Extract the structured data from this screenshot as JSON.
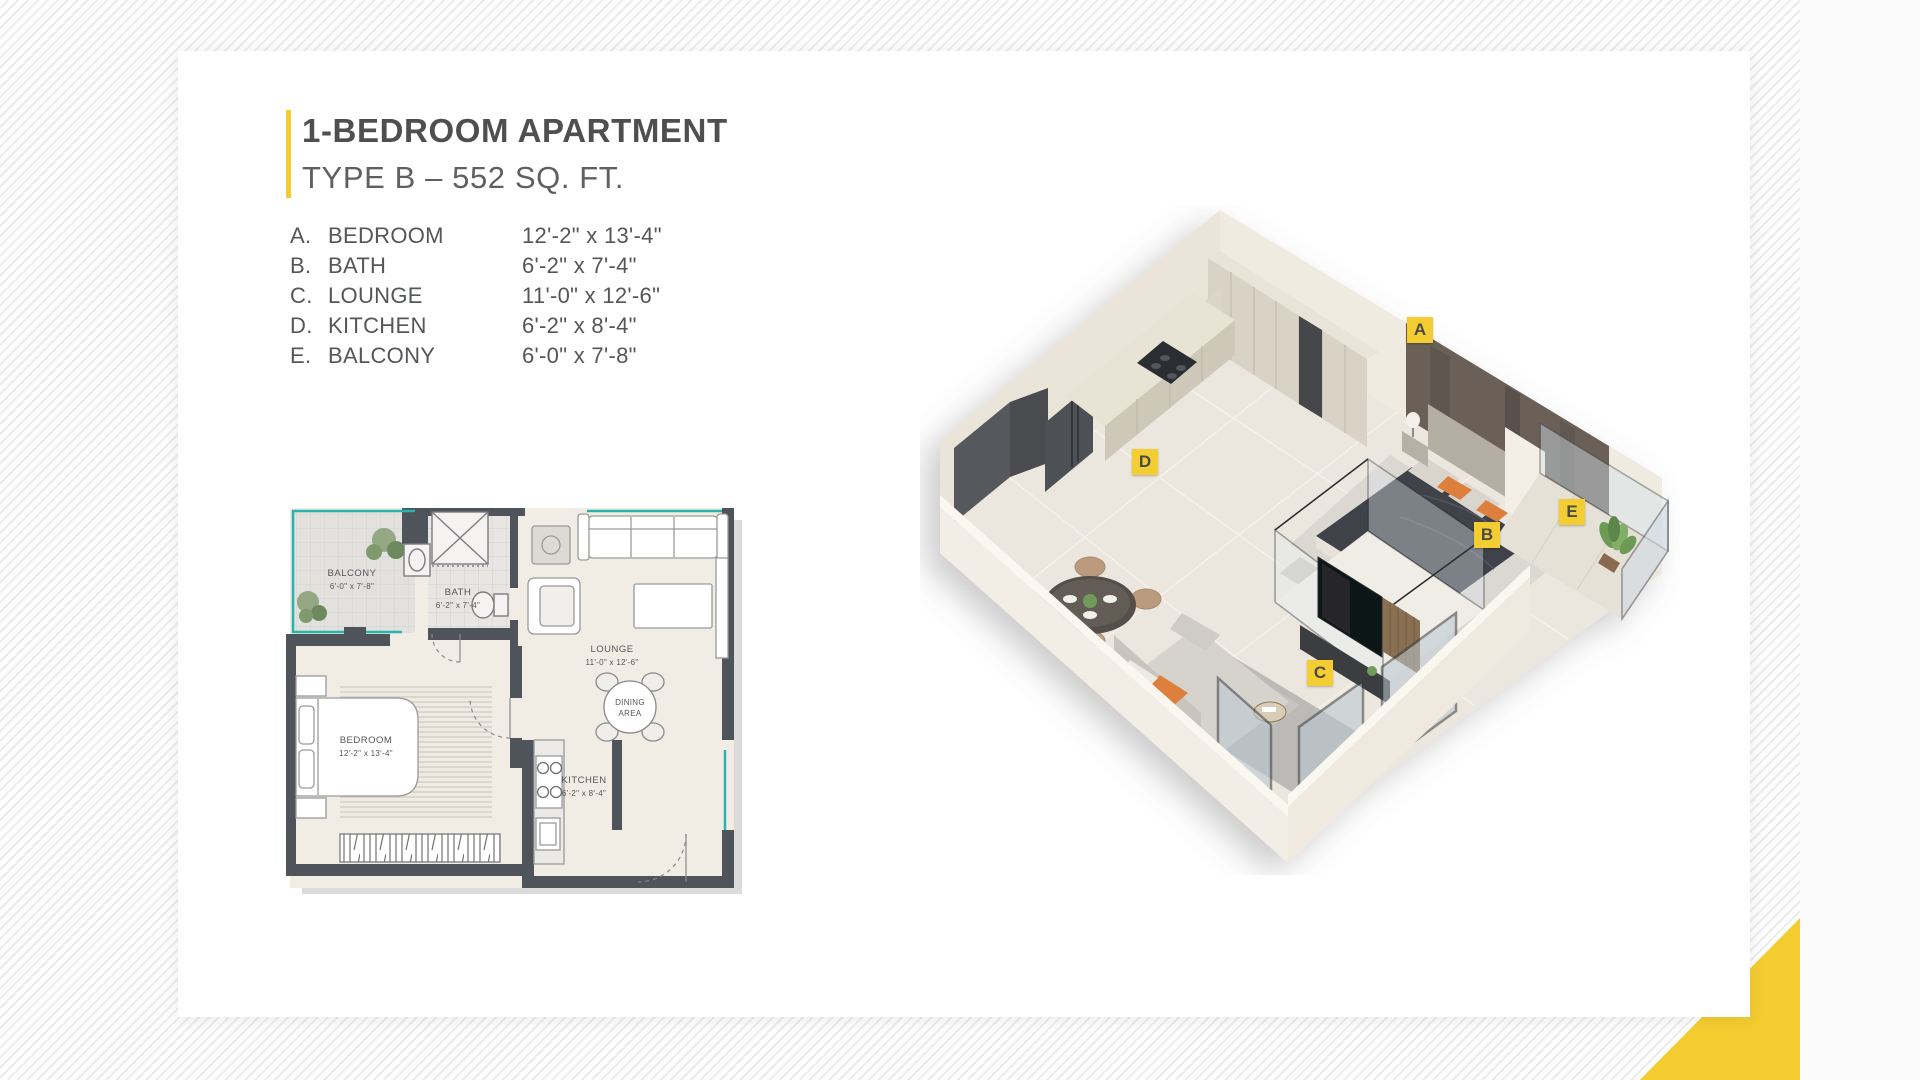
{
  "page": {
    "title": "1-BEDROOM APARTMENT",
    "subtitle": "TYPE B – 552 SQ. FT."
  },
  "legend": {
    "rooms": [
      {
        "letter": "A.",
        "name": "BEDROOM",
        "dims": "12'-2\" x 13'-4\""
      },
      {
        "letter": "B.",
        "name": "BATH",
        "dims": "6'-2\" x 7'-4\""
      },
      {
        "letter": "C.",
        "name": "LOUNGE",
        "dims": "11'-0\" x 12'-6\""
      },
      {
        "letter": "D.",
        "name": "KITCHEN",
        "dims": "6'-2\" x 8'-4\""
      },
      {
        "letter": "E.",
        "name": "BALCONY",
        "dims": "6'-0\" x 7'-8\""
      }
    ]
  },
  "plan2d": {
    "labels": {
      "balcony": {
        "name": "BALCONY",
        "dims": "6'-0\" x 7'-8\""
      },
      "bath": {
        "name": "BATH",
        "dims": "6'-2\" x 7'-4\""
      },
      "lounge": {
        "name": "LOUNGE",
        "dims": "11'-0\" x 12'-6\""
      },
      "dining": {
        "line1": "DINING",
        "line2": "AREA"
      },
      "bedroom": {
        "name": "BEDROOM",
        "dims": "12'-2\" x 13'-4\""
      },
      "kitchen": {
        "name": "KITCHEN",
        "dims": "6'-2\" x 8'-4\""
      }
    }
  },
  "plan3d": {
    "markers": [
      {
        "letter": "A"
      },
      {
        "letter": "B"
      },
      {
        "letter": "C"
      },
      {
        "letter": "D"
      },
      {
        "letter": "E"
      }
    ]
  },
  "colors": {
    "accent_yellow": "#F3CC30",
    "glass_teal": "#2CB3AE",
    "text_gray": "#55565A"
  }
}
